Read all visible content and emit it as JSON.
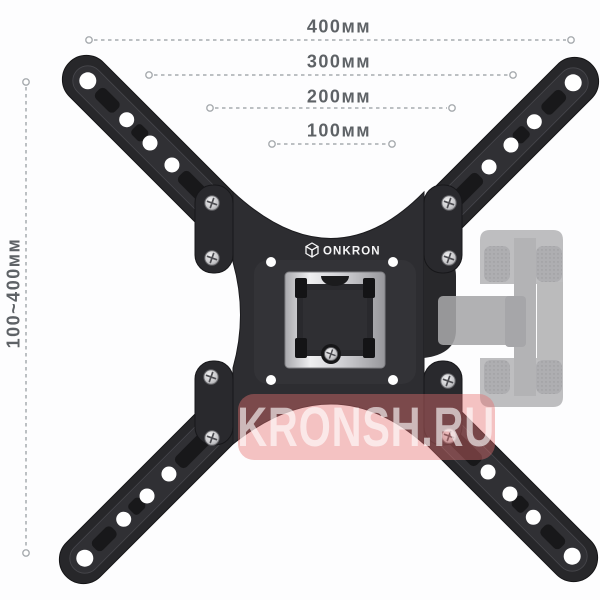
{
  "annotations": {
    "top_dimensions": [
      {
        "label": "400мм"
      },
      {
        "label": "300мм"
      },
      {
        "label": "200мм"
      },
      {
        "label": "100мм"
      }
    ],
    "side_dimension": {
      "label": "100~400мм"
    }
  },
  "product": {
    "brand": "ONKRON"
  },
  "watermark": {
    "text": "KRONSH.RU"
  },
  "colors": {
    "background": "#fdfdfe",
    "dimension_line": "#a7abaf",
    "dimension_text": "#5e6266",
    "bracket_black": "#27272a",
    "bracket_face": "#303034",
    "metal_bright": "#e9e9eb",
    "ghost_gray": "#b6b6b8",
    "watermark_band": "#e67070",
    "watermark_text": "#ffffff",
    "hole_white": "#ffffff"
  }
}
